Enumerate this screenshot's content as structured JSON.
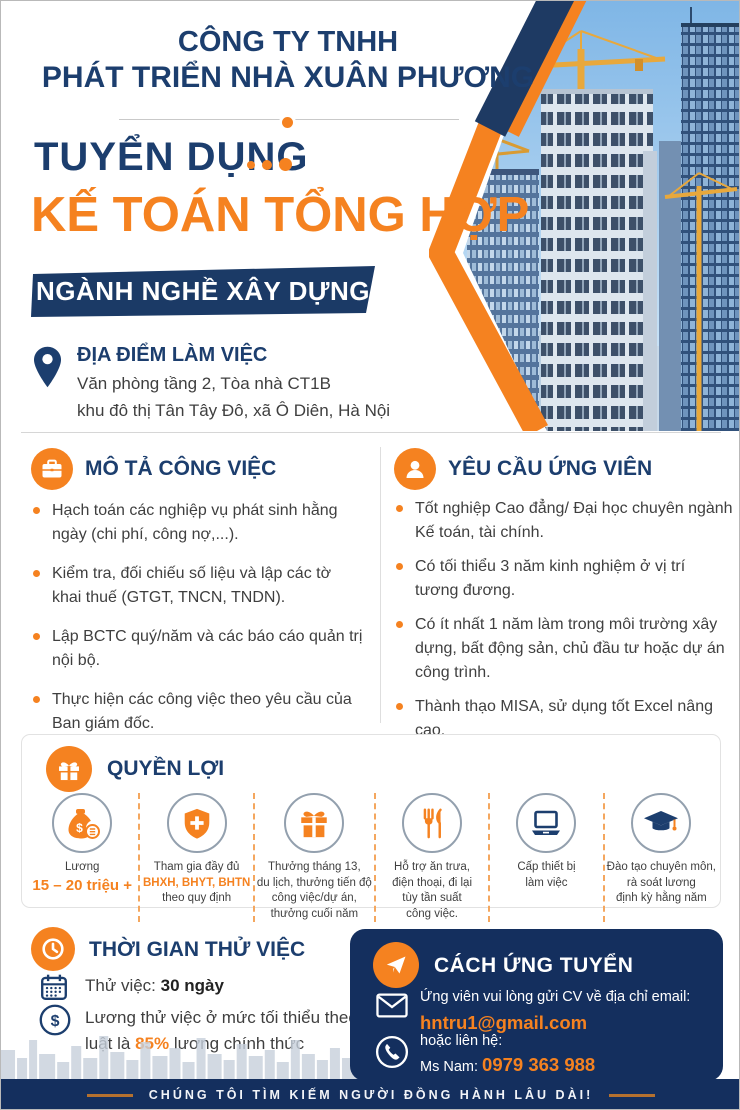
{
  "colors": {
    "navy": "#1c3e6e",
    "banner_navy": "#1b3a66",
    "card_navy": "#142f5e",
    "orange": "#f58220",
    "body_text": "#3f3f3f"
  },
  "header": {
    "company_line1": "CÔNG TY TNHH",
    "company_line2": "PHÁT TRIỂN NHÀ XUÂN PHƯƠNG",
    "recruit_label": "TUYỂN DỤNG",
    "position": "KẾ TOÁN TỔNG HỢP",
    "industry_banner": "NGÀNH NGHỀ XÂY DỰNG"
  },
  "location": {
    "title": "ĐỊA ĐIỂM LÀM VIỆC",
    "line1": "Văn phòng tầng 2, Tòa nhà CT1B",
    "line2": "khu đô thị Tân Tây Đô, xã Ô Diên, Hà Nội"
  },
  "job_description": {
    "title": "MÔ TẢ CÔNG VIỆC",
    "icon": "briefcase-icon",
    "items": [
      "Hạch toán các nghiệp vụ phát sinh hằng ngày (chi phí, công nợ,...).",
      "Kiểm tra, đối chiếu số liệu và lập các tờ khai thuế (GTGT, TNCN, TNDN).",
      "Lập BCTC quý/năm và các báo cáo quản trị nội bộ.",
      "Thực hiện các công việc theo yêu cầu của Ban giám đốc."
    ]
  },
  "requirements": {
    "title": "YÊU CẦU ỨNG VIÊN",
    "icon": "person-icon",
    "items": [
      "Tốt nghiệp Cao đẳng/ Đại học chuyên ngành Kế toán, tài chính.",
      "Có tối thiểu 3 năm kinh nghiệm ở vị trí tương đương.",
      "Có ít nhất 1 năm làm trong môi trường xây dựng, bất động sản, chủ đầu tư hoặc dự án công trình.",
      "Thành thạo MISA, sử dụng tốt Excel nâng cao.",
      "Am hiểu về Thuế, Luật doanh nghiệp.",
      "Cẩn thận, trung thực và chịu được áp lực công việc."
    ]
  },
  "benefits": {
    "title": "QUYỀN LỢI",
    "icon": "gift-icon",
    "items": [
      {
        "icon": "money-bag-icon",
        "lines": [
          {
            "text": "Lương"
          },
          {
            "text": "15 – 20 triệu +",
            "accent": true,
            "large": true
          }
        ]
      },
      {
        "icon": "shield-plus-icon",
        "lines": [
          {
            "text": "Tham gia đầy đủ"
          },
          {
            "text": "BHXH, BHYT, BHTN",
            "accent": true
          },
          {
            "text": "theo quy định"
          }
        ]
      },
      {
        "icon": "gift-box-icon",
        "lines": [
          {
            "text": "Thưởng tháng 13,"
          },
          {
            "text": "du lịch, thưởng tiến độ"
          },
          {
            "text": "công việc/dự án,"
          },
          {
            "text": "thưởng cuối năm"
          }
        ]
      },
      {
        "icon": "utensils-icon",
        "lines": [
          {
            "text": "Hỗ trợ ăn trưa,"
          },
          {
            "text": "điện thoại, đi lại"
          },
          {
            "text": "tùy tần suất"
          },
          {
            "text": "công việc."
          }
        ]
      },
      {
        "icon": "laptop-icon",
        "lines": [
          {
            "text": "Cấp thiết bị"
          },
          {
            "text": "làm việc"
          }
        ]
      },
      {
        "icon": "graduation-cap-icon",
        "lines": [
          {
            "text": "Đào tạo chuyên môn,"
          },
          {
            "text": "rà soát lương"
          },
          {
            "text": "định kỳ hằng năm"
          }
        ]
      }
    ]
  },
  "probation": {
    "title": "THỜI GIAN THỬ VIỆC",
    "icon": "clock-icon",
    "row1": {
      "icon": "calendar-icon",
      "segments": [
        {
          "text": "Thử việc: "
        },
        {
          "text": "30 ngày",
          "bold": true
        }
      ]
    },
    "row2": {
      "icon": "dollar-circle-icon",
      "segments": [
        {
          "text": "Lương thử việc ở mức tối thiểu theo luật là "
        },
        {
          "text": "85%",
          "accent": true
        },
        {
          "text": " lương chính thức"
        }
      ]
    }
  },
  "apply": {
    "title": "CÁCH ỨNG TUYỂN",
    "icon": "paper-plane-icon",
    "email_row": {
      "icon": "envelope-icon",
      "segments": [
        {
          "text": "Ứng viên vui lòng gửi CV về địa chỉ email:",
          "nl": true
        },
        {
          "text": "hntru1@gmail.com",
          "accent": true
        }
      ]
    },
    "phone_row": {
      "icon": "phone-icon",
      "segments": [
        {
          "text": "hoặc liên hệ:",
          "nl": true
        },
        {
          "text": "Ms Nam: "
        },
        {
          "text": "0979 363 988",
          "accent": true
        }
      ]
    }
  },
  "footer": {
    "text": "CHÚNG TÔI TÌM KIẾM NGƯỜI ĐỒNG HÀNH LÂU DÀI!"
  }
}
